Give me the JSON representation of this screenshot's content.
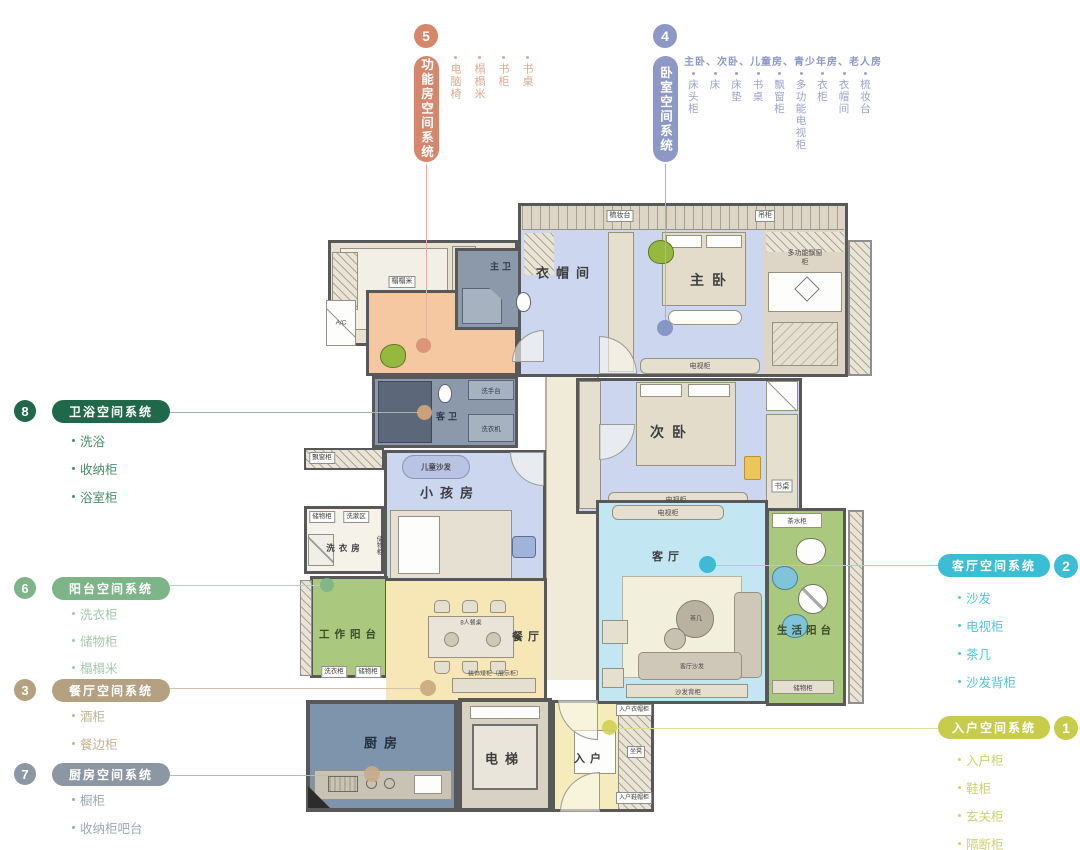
{
  "callouts": {
    "functional": {
      "number": "5",
      "title": "功能房空间系统",
      "color": "#d6866a",
      "item_color": "#dcab93",
      "items": [
        "电脑椅",
        "榻榻米",
        "书柜",
        "书桌"
      ]
    },
    "bedroom": {
      "number": "4",
      "title": "卧室空间系统",
      "color": "#8d98c6",
      "item_color": "#9aa4cb",
      "header": "主卧、次卧、儿童房、青少年房、老人房",
      "items": [
        "床头柜",
        "床",
        "床垫",
        "书桌",
        "飘窗柜",
        "多功能电视柜",
        "衣柜",
        "衣帽间",
        "梳妆台"
      ]
    },
    "bath": {
      "number": "8",
      "title": "卫浴空间系统",
      "color": "#20684a",
      "item_color": "#4a8f6d",
      "items": [
        "洗浴",
        "收纳柜",
        "浴室柜"
      ]
    },
    "balcony": {
      "number": "6",
      "title": "阳台空间系统",
      "color": "#7db488",
      "item_color": "#a3c9ab",
      "items": [
        "洗衣柜",
        "储物柜",
        "榻榻米",
        "茶水柜"
      ]
    },
    "dining": {
      "number": "3",
      "title": "餐厅空间系统",
      "color": "#b3a181",
      "item_color": "#c6b395",
      "items": [
        "酒柜",
        "餐边柜",
        "餐桌椅"
      ]
    },
    "kitchen": {
      "number": "7",
      "title": "厨房空间系统",
      "color": "#8b97a3",
      "item_color": "#9fa9b2",
      "items": [
        "橱柜",
        "收纳柜吧台",
        "烹调区"
      ]
    },
    "living": {
      "number": "2",
      "title": "客厅空间系统",
      "color": "#3cbdd6",
      "item_color": "#55c5db",
      "items": [
        "沙发",
        "电视柜",
        "茶几",
        "沙发背柜"
      ]
    },
    "entry": {
      "number": "1",
      "title": "入户空间系统",
      "color": "#c8cc4b",
      "item_color": "#ced173",
      "items": [
        "入户柜",
        "鞋柜",
        "玄关柜",
        "隔断柜"
      ]
    }
  },
  "markers": {
    "functional": "#d98e75",
    "bedroom": "#7f8fc0",
    "bath": "#d7a77c",
    "balcony": "#7db488",
    "dining": "#c8a87f",
    "kitchen": "#c9ab8a",
    "living": "#2fb6cf",
    "entry": "#cfd254"
  },
  "leader_colors": {
    "functional": "#dcb39e",
    "bedroom": "#a8b0d5",
    "bath": "#aab4ad",
    "balcony": "#b5d2ba",
    "dining": "#d2c4ac",
    "kitchen": "#b4bcc2",
    "living": "#8ed8e6",
    "entry": "#dbdd90"
  },
  "plan": {
    "rooms": {
      "tatami": "榻榻米",
      "master_bath": "主卫",
      "cloakroom": "衣帽间",
      "master_bedroom": "主卧",
      "second_bedroom": "次卧",
      "guest_bath": "客卫",
      "kids_room": "小孩房",
      "laundry": "洗衣房",
      "work_balcony": "工作阳台",
      "dining": "餐厅",
      "kitchen": "厨房",
      "elevator": "电梯",
      "entry": "入户",
      "living": "客厅",
      "life_balcony": "生活阳台"
    },
    "labels": {
      "dresser": "梳妆台",
      "hanging_cabinet": "吊柜",
      "bay_window_cabinet_multi": "多功能飘窗柜",
      "tv_cabinet": "电视柜",
      "desk": "书桌",
      "kids_sofa": "儿童沙发",
      "wash_basin": "洗手台",
      "washing_machine": "洗衣机",
      "wash_area": "洗漱区",
      "storage_cabinet": "储物柜",
      "bay_window_cabinet": "飘窗柜",
      "laundry_cabinet": "洗衣柜",
      "dining_table": "8人餐桌",
      "low_display_cabinet": "装饰矮柜（展示柜）",
      "tea_cabinet": "茶水柜",
      "coffee_table": "茶几",
      "living_sofa": "客厅沙发",
      "sofa_back_cabinet": "沙发背柜",
      "entry_coat_cabinet": "入户衣帽柜",
      "bench": "坐凳",
      "entry_shoe_cabinet": "入户鞋帽柜",
      "ac": "A/C"
    }
  }
}
